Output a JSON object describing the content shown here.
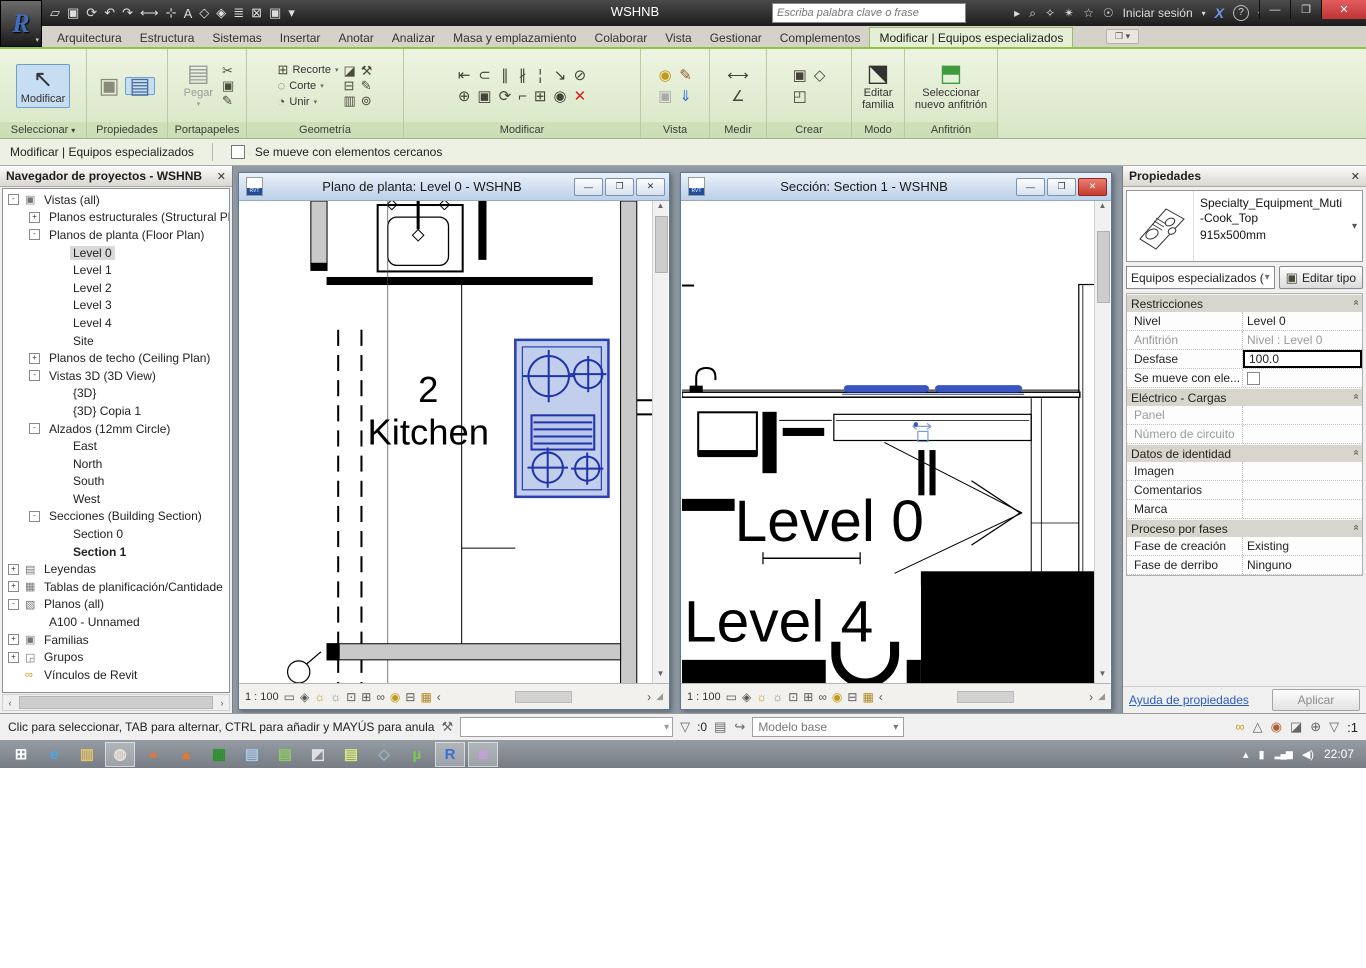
{
  "window": {
    "title": "WSHNB",
    "search_placeholder": "Escriba palabra clave o frase",
    "sign_in_label": "Iniciar sesión"
  },
  "glyphs": {
    "chevron_down": "▾",
    "chevron_up": "▴",
    "minimize": "—",
    "restore": "❐",
    "close": "✕",
    "arrow_right": "▸",
    "arrow_left": "◂",
    "arrow_up": "▲",
    "arrow_down": "▼",
    "lt": "‹",
    "gt": "›",
    "search": "⌕",
    "key": "✧",
    "satellite": "✴",
    "star": "☆",
    "person": "☉",
    "exchange": "X",
    "help": "?",
    "cursor": "↖",
    "resize": "◢",
    "section_chevrons": "»",
    "rlogo": "R",
    "logo_caret": "▾"
  },
  "qat": [
    {
      "name": "open-icon",
      "glyph": "▱"
    },
    {
      "name": "save-icon",
      "glyph": "▣"
    },
    {
      "name": "sync-icon",
      "glyph": "⟳"
    },
    {
      "name": "undo-icon",
      "glyph": "↶"
    },
    {
      "name": "redo-icon",
      "glyph": "↷"
    },
    {
      "name": "measure-icon",
      "glyph": "⟷"
    },
    {
      "name": "aligned-dimension-icon",
      "glyph": "⊹"
    },
    {
      "name": "text-icon",
      "glyph": "A"
    },
    {
      "name": "default-3d-view-icon",
      "glyph": "◇"
    },
    {
      "name": "section-icon",
      "glyph": "◈"
    },
    {
      "name": "thin-lines-icon",
      "glyph": "≣"
    },
    {
      "name": "close-hidden-windows-icon",
      "glyph": "⊠"
    },
    {
      "name": "switch-windows-icon",
      "glyph": "▣"
    },
    {
      "name": "customize-qat-icon",
      "glyph": "▾"
    }
  ],
  "tabs": [
    {
      "label": "Arquitectura"
    },
    {
      "label": "Estructura"
    },
    {
      "label": "Sistemas"
    },
    {
      "label": "Insertar"
    },
    {
      "label": "Anotar"
    },
    {
      "label": "Analizar"
    },
    {
      "label": "Masa y emplazamiento"
    },
    {
      "label": "Colaborar"
    },
    {
      "label": "Vista"
    },
    {
      "label": "Gestionar"
    },
    {
      "label": "Complementos"
    },
    {
      "label": "Modificar | Equipos especializados",
      "active": true
    }
  ],
  "ribbon": {
    "panels": {
      "seleccionar": "Seleccionar",
      "propiedades": "Propiedades",
      "portapapeles": "Portapapeles",
      "geometria": "Geometría",
      "modificar": "Modificar",
      "vista": "Vista",
      "medir": "Medir",
      "crear": "Crear",
      "modo": "Modo",
      "anfitrion": "Anfitrión"
    },
    "buttons": {
      "modificar": "Modificar",
      "pegar": "Pegar",
      "recorte": "Recorte",
      "corte": "Corte",
      "unir": "Unir",
      "editar_familia": "Editar familia",
      "sel_anfitrion": "Seleccionar nuevo anfitrión"
    },
    "geometry_rows": [
      {
        "name": "wall-joins-icon",
        "glyph": "⊞",
        "label": "Recorte"
      },
      {
        "name": "cut-icon",
        "glyph": "◌",
        "label": "Corte"
      },
      {
        "name": "join-icon",
        "glyph": "◔",
        "label": "Unir"
      }
    ],
    "geometry_icons": [
      {
        "name": "apply-coping-icon",
        "glyph": "◪"
      },
      {
        "name": "remove-coping-icon",
        "glyph": "⊟"
      },
      {
        "name": "beam-joins-icon",
        "glyph": "▥"
      },
      {
        "name": "demolish-icon",
        "glyph": "⚒"
      },
      {
        "name": "paint-icon",
        "glyph": "✎"
      },
      {
        "name": "split-face-icon",
        "glyph": "⊚"
      }
    ],
    "modify_icons": [
      {
        "name": "align-icon",
        "glyph": "⇤"
      },
      {
        "name": "move-icon",
        "glyph": "⊕"
      },
      {
        "name": "offset-icon",
        "glyph": "⊂"
      },
      {
        "name": "copy-icon",
        "glyph": "▣"
      },
      {
        "name": "mirror-axis-icon",
        "glyph": "∥"
      },
      {
        "name": "rotate-icon",
        "glyph": "⟳"
      },
      {
        "name": "mirror-line-icon",
        "glyph": "∦"
      },
      {
        "name": "trim-extend-icon",
        "glyph": "⌐"
      },
      {
        "name": "split-icon",
        "glyph": "¦"
      },
      {
        "name": "array-icon",
        "glyph": "⊞"
      },
      {
        "name": "scale-icon",
        "glyph": "↘"
      },
      {
        "name": "pin-icon",
        "glyph": "◉"
      },
      {
        "name": "unpin-icon",
        "glyph": "⊘"
      },
      {
        "name": "delete-icon",
        "glyph": "✕",
        "color": "#cc2222"
      }
    ],
    "view_icons": [
      {
        "name": "lightbulb-icon",
        "glyph": "◉",
        "color": "#c29a1a"
      },
      {
        "name": "render-icon",
        "glyph": "▣",
        "color": "#aaa"
      },
      {
        "name": "linework-icon",
        "glyph": "✎",
        "color": "#8a5a2a"
      },
      {
        "name": "displace-icon",
        "glyph": "⇓",
        "color": "#3a6fd8"
      }
    ],
    "measure_icons": [
      {
        "name": "measure-between-icon",
        "glyph": "⟷"
      },
      {
        "name": "angle-icon",
        "glyph": "∠"
      }
    ],
    "create_icons": [
      {
        "name": "create-group-icon",
        "glyph": "▣"
      },
      {
        "name": "create-similar-icon",
        "glyph": "◰"
      },
      {
        "name": "create-assembly-icon",
        "glyph": "◇"
      }
    ]
  },
  "title_icons": [
    {
      "name": "search-go-icon",
      "glyph": "⌕"
    },
    {
      "name": "communication-center-icon",
      "glyph": "✧"
    },
    {
      "name": "subscription-center-icon",
      "glyph": "✴"
    },
    {
      "name": "favorites-icon",
      "glyph": "☆"
    },
    {
      "name": "sign-in-icon",
      "glyph": "☉"
    }
  ],
  "options_bar": {
    "context_label": "Modificar | Equipos especializados",
    "checkbox_label": "Se mueve con elementos cercanos"
  },
  "browser": {
    "title": "Navegador de proyectos - WSHNB",
    "tree": [
      {
        "label": "Vistas (all)",
        "indent": 0,
        "toggle": "-",
        "icon": "views"
      },
      {
        "label": "Planos estructurales (Structural Pla",
        "indent": 1,
        "toggle": "+"
      },
      {
        "label": "Planos de planta (Floor Plan)",
        "indent": 1,
        "toggle": "-"
      },
      {
        "label": "Level 0",
        "indent": 2,
        "selected": true
      },
      {
        "label": "Level 1",
        "indent": 2
      },
      {
        "label": "Level 2",
        "indent": 2
      },
      {
        "label": "Level 3",
        "indent": 2
      },
      {
        "label": "Level 4",
        "indent": 2
      },
      {
        "label": "Site",
        "indent": 2
      },
      {
        "label": "Planos de techo (Ceiling Plan)",
        "indent": 1,
        "toggle": "+"
      },
      {
        "label": "Vistas 3D (3D View)",
        "indent": 1,
        "toggle": "-"
      },
      {
        "label": "{3D}",
        "indent": 2
      },
      {
        "label": "{3D} Copia 1",
        "indent": 2
      },
      {
        "label": "Alzados (12mm Circle)",
        "indent": 1,
        "toggle": "-"
      },
      {
        "label": "East",
        "indent": 2
      },
      {
        "label": "North",
        "indent": 2
      },
      {
        "label": "South",
        "indent": 2
      },
      {
        "label": "West",
        "indent": 2
      },
      {
        "label": "Secciones (Building Section)",
        "indent": 1,
        "toggle": "-"
      },
      {
        "label": "Section 0",
        "indent": 2
      },
      {
        "label": "Section 1",
        "indent": 2,
        "bold": true
      },
      {
        "label": "Leyendas",
        "indent": 0,
        "toggle": "+",
        "icon": "legend"
      },
      {
        "label": "Tablas de planificación/Cantidade",
        "indent": 0,
        "toggle": "+",
        "icon": "schedule"
      },
      {
        "label": "Planos (all)",
        "indent": 0,
        "toggle": "-",
        "icon": "sheet"
      },
      {
        "label": "A100 - Unnamed",
        "indent": 1
      },
      {
        "label": "Familias",
        "indent": 0,
        "toggle": "+",
        "icon": "family"
      },
      {
        "label": "Grupos",
        "indent": 0,
        "toggle": "+",
        "icon": "group"
      },
      {
        "label": "Vínculos de Revit",
        "indent": 0,
        "icon": "link"
      }
    ]
  },
  "views": [
    {
      "title": "Plano de planta: Level 0 - WSHNB",
      "scale": "1 : 100",
      "room_number": "2",
      "room_name": "Kitchen"
    },
    {
      "title": "Sección: Section 1 - WSHNB",
      "scale": "1 : 100",
      "level0": "Level 0",
      "level4": "Level 4"
    }
  ],
  "view_ctrl_icons": [
    {
      "name": "detail-level-icon",
      "glyph": "▭",
      "color": "#555"
    },
    {
      "name": "visual-style-icon",
      "glyph": "◈",
      "color": "#555"
    },
    {
      "name": "sun-path-icon",
      "glyph": "☼",
      "color": "#c29a1a"
    },
    {
      "name": "shadows-icon",
      "glyph": "☼",
      "color": "#888"
    },
    {
      "name": "crop-view-icon",
      "glyph": "⊡",
      "color": "#555"
    },
    {
      "name": "crop-region-visibility-icon",
      "glyph": "⊞",
      "color": "#555"
    },
    {
      "name": "temporary-hide-isolate-icon",
      "glyph": "∞",
      "color": "#555"
    },
    {
      "name": "reveal-hidden-icon",
      "glyph": "◉",
      "color": "#c29a1a"
    },
    {
      "name": "temporary-view-properties-icon",
      "glyph": "⊟",
      "color": "#555"
    },
    {
      "name": "worksharing-display-icon",
      "glyph": "▦",
      "color": "#b08820"
    }
  ],
  "props": {
    "title": "Propiedades",
    "type_name": "Specialty_Equipment_Muti-Cook_Top",
    "type_size": "915x500mm",
    "type_category": "Equipos especializados (",
    "edit_type_label": "Editar tipo",
    "grid": [
      {
        "kind": "section",
        "label": "Restricciones"
      },
      {
        "kind": "row",
        "label": "Nivel",
        "value": "Level 0"
      },
      {
        "kind": "row",
        "label": "Anfitrión",
        "value": "Nivel : Level 0",
        "disabled": true
      },
      {
        "kind": "row",
        "label": "Desfase",
        "value": "100.0",
        "editing": true
      },
      {
        "kind": "row",
        "label": "Se mueve con ele...",
        "value": "",
        "checkbox": true
      },
      {
        "kind": "section",
        "label": "Eléctrico - Cargas"
      },
      {
        "kind": "row",
        "label": "Panel",
        "value": "",
        "disabled": true
      },
      {
        "kind": "row",
        "label": "Número de circuito",
        "value": "",
        "disabled": true
      },
      {
        "kind": "section",
        "label": "Datos de identidad"
      },
      {
        "kind": "row",
        "label": "Imagen",
        "value": ""
      },
      {
        "kind": "row",
        "label": "Comentarios",
        "value": ""
      },
      {
        "kind": "row",
        "label": "Marca",
        "value": ""
      },
      {
        "kind": "section",
        "label": "Proceso por fases"
      },
      {
        "kind": "row",
        "label": "Fase de creación",
        "value": "Existing"
      },
      {
        "kind": "row",
        "label": "Fase de derribo",
        "value": "Ninguno"
      }
    ],
    "help_link": "Ayuda de propiedades",
    "apply_label": "Aplicar"
  },
  "status": {
    "hint": "Clic para seleccionar, TAB para alternar, CTRL para añadir y MAYÚS para anula",
    "worker_icon": "⚒",
    "left_count": ":0",
    "model_label": "Modelo base",
    "right_count": ":1",
    "left_icons": [
      {
        "name": "editable-only-icon",
        "glyph": "▤"
      },
      {
        "name": "design-options-icon",
        "glyph": "↪"
      }
    ],
    "right_icons": [
      {
        "name": "select-links-icon",
        "glyph": "∞",
        "color": "#c8a020"
      },
      {
        "name": "select-underlay-icon",
        "glyph": "△",
        "color": "#666"
      },
      {
        "name": "select-pinned-icon",
        "glyph": "◉",
        "color": "#b06030"
      },
      {
        "name": "select-by-face-icon",
        "glyph": "◪",
        "color": "#666"
      },
      {
        "name": "drag-on-selection-icon",
        "glyph": "⊕",
        "color": "#666"
      }
    ]
  },
  "taskbar": {
    "items": [
      {
        "name": "start-button",
        "glyph": "⊞",
        "color": "#ffffff"
      },
      {
        "name": "ie-icon",
        "glyph": "e",
        "color": "#49a8e8"
      },
      {
        "name": "explorer-icon",
        "glyph": "▥",
        "color": "#e7c46a"
      },
      {
        "name": "chrome-icon",
        "glyph": "◍",
        "color": "#e8e3d8",
        "framed": true
      },
      {
        "name": "firefox-icon",
        "glyph": "◕",
        "color": "#e8762d"
      },
      {
        "name": "vlc-icon",
        "glyph": "▲",
        "color": "#e8762d"
      },
      {
        "name": "spreadsheet-app-icon",
        "glyph": "▦",
        "color": "#2f8f2f"
      },
      {
        "name": "writer-app-icon",
        "glyph": "▤",
        "color": "#a8c8e8"
      },
      {
        "name": "calc-app-icon",
        "glyph": "▤",
        "color": "#8fc864"
      },
      {
        "name": "photo-app-icon",
        "glyph": "◩",
        "color": "#e0e0e0"
      },
      {
        "name": "notes-app-icon",
        "glyph": "▤",
        "color": "#d8e87a"
      },
      {
        "name": "mini-app-icon",
        "glyph": "◇",
        "color": "#9ab0c0"
      },
      {
        "name": "utorrent-icon",
        "glyph": "µ",
        "color": "#7ec850"
      },
      {
        "name": "revit-icon",
        "glyph": "R",
        "color": "#3a6fd8",
        "framed": true
      },
      {
        "name": "gallery-app-icon",
        "glyph": "◙",
        "color": "#c8a0d8",
        "framed": true
      }
    ],
    "tray_arrow": "▴",
    "battery": "▮",
    "signal": "▂▄▆",
    "volume": "◀)",
    "time": "22:07"
  }
}
